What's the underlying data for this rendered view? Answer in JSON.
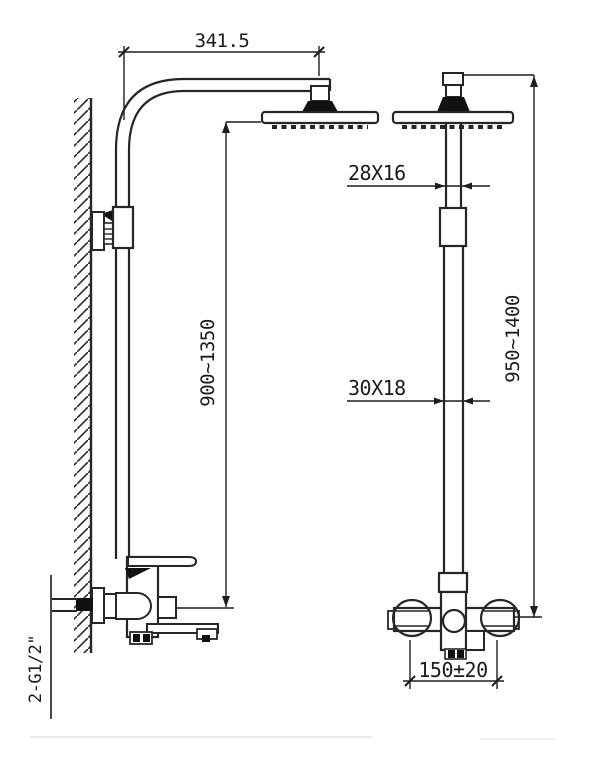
{
  "drawing": {
    "colors": {
      "background": "#ffffff",
      "part_line": "#262626",
      "dim_line": "#1d1d1d",
      "solid_fill": "#111111",
      "faint_line": "#c9c9c9"
    },
    "labels": {
      "arm_reach": "341.5",
      "upper_tube_section": "28X16",
      "lower_tube_section": "30X18",
      "riser_height_range": "900~1350",
      "overall_height_range": "950~1400",
      "inlet_spacing": "150±20",
      "inlet_thread": "2-G1/2\""
    }
  }
}
